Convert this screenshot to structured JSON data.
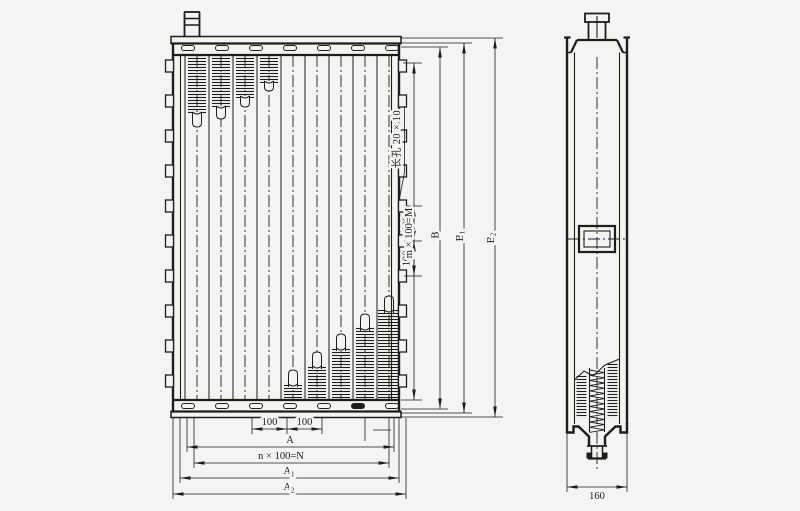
{
  "annotations": {
    "slot_note": "长孔 20 × 10",
    "v_pitch_upper": "100",
    "v_pitch_lower": "100",
    "dim_m": "m × 100=M",
    "dim_b": "B",
    "dim_b1_base": "B",
    "dim_b1_sub": "1",
    "dim_b2_base": "B",
    "dim_b2_sub": "2",
    "h_pitch_left": "100",
    "h_pitch_right": "100",
    "dim_a": "A",
    "dim_n": "n × 100=N",
    "dim_a1_base": "A",
    "dim_a1_sub": "1",
    "dim_a2_base": "A",
    "dim_a2_sub": "2",
    "side_width": "160"
  },
  "colors": {
    "ink": "#1d1d1b",
    "paper": "#f4f4f2"
  }
}
